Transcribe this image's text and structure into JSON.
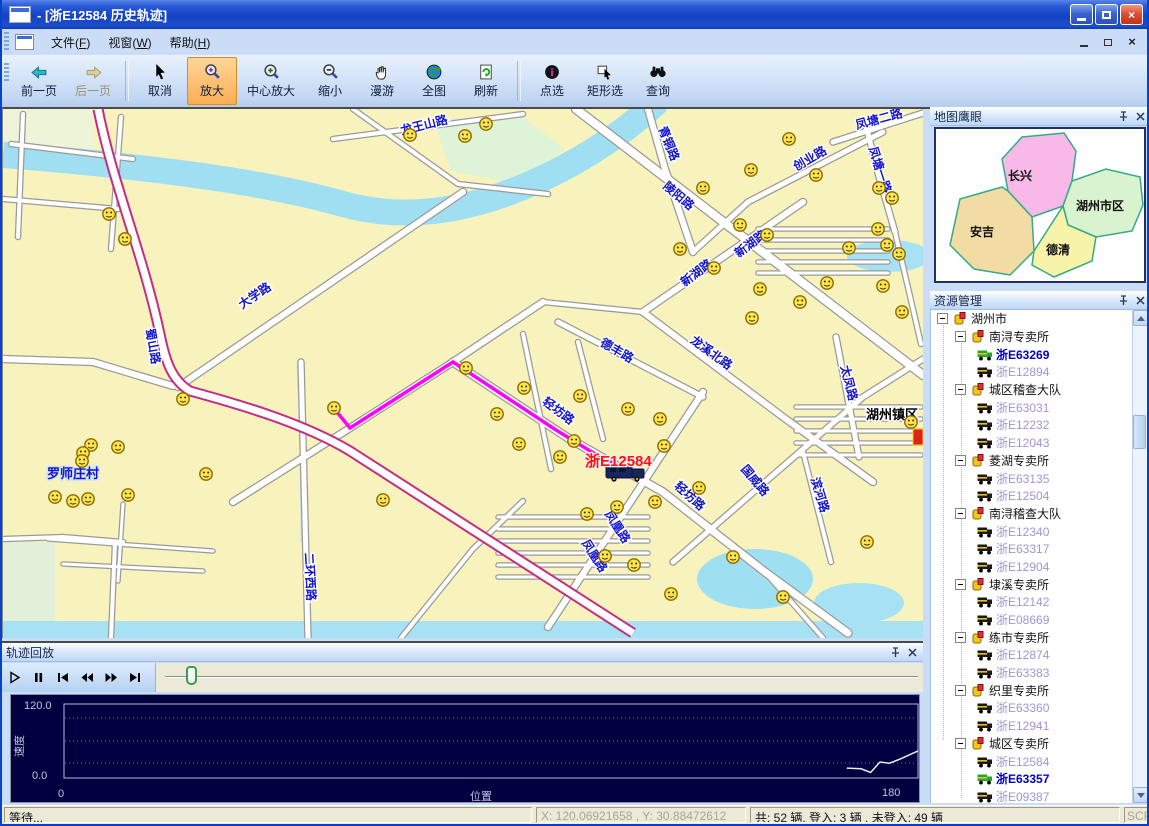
{
  "window": {
    "title": "- [浙E12584 历史轨迹]",
    "controls": [
      "minimize",
      "restore",
      "close"
    ]
  },
  "menu": {
    "items": [
      "文件(F)",
      "视窗(W)",
      "帮助(H)"
    ],
    "mdi_controls": [
      "minimize",
      "restore",
      "close"
    ]
  },
  "toolbar": {
    "buttons": [
      {
        "label": "前一页",
        "icon": "page-prev"
      },
      {
        "label": "后一页",
        "icon": "page-next",
        "disabled": true
      },
      {
        "sep": true
      },
      {
        "label": "取消",
        "icon": "cursor"
      },
      {
        "label": "放大",
        "icon": "zoom-in",
        "active": true
      },
      {
        "label": "中心放大",
        "icon": "zoom-center"
      },
      {
        "label": "缩小",
        "icon": "zoom-out"
      },
      {
        "label": "漫游",
        "icon": "pan-hand"
      },
      {
        "label": "全图",
        "icon": "globe"
      },
      {
        "label": "刷新",
        "icon": "refresh"
      },
      {
        "sep": true
      },
      {
        "label": "点选",
        "icon": "info-point"
      },
      {
        "label": "矩形选",
        "icon": "rect-select"
      },
      {
        "label": "查询",
        "icon": "binoculars"
      }
    ]
  },
  "map": {
    "road_labels": [
      {
        "t": "龙王山路",
        "x": 422,
        "y": 20,
        "r": -14
      },
      {
        "t": "青铜路",
        "x": 662,
        "y": 36,
        "r": 68
      },
      {
        "t": "陵阳路",
        "x": 673,
        "y": 90,
        "r": 40
      },
      {
        "t": "创业路",
        "x": 809,
        "y": 53,
        "r": -30
      },
      {
        "t": "凤塘二路",
        "x": 877,
        "y": 14,
        "r": -15
      },
      {
        "t": "凤塘一路",
        "x": 873,
        "y": 62,
        "r": 72
      },
      {
        "t": "新湖路",
        "x": 696,
        "y": 167,
        "r": -37
      },
      {
        "t": "大学路",
        "x": 254,
        "y": 190,
        "r": -34
      },
      {
        "t": "蜀山路",
        "x": 146,
        "y": 238,
        "r": 80
      },
      {
        "t": "德丰路",
        "x": 612,
        "y": 245,
        "r": 30
      },
      {
        "t": "龙溪北路",
        "x": 706,
        "y": 247,
        "r": 36
      },
      {
        "t": "轻坊路",
        "x": 553,
        "y": 305,
        "r": 37
      },
      {
        "t": "轻坊路",
        "x": 684,
        "y": 390,
        "r": 42
      },
      {
        "t": "凤凰路",
        "x": 588,
        "y": 449,
        "r": 57
      },
      {
        "t": "凤凰路",
        "x": 611,
        "y": 420,
        "r": 57
      },
      {
        "t": "国威路",
        "x": 749,
        "y": 374,
        "r": 50
      },
      {
        "t": "太凤路",
        "x": 842,
        "y": 275,
        "r": 76
      },
      {
        "t": "滨河路",
        "x": 813,
        "y": 387,
        "r": 73
      },
      {
        "t": "二环西路",
        "x": 303,
        "y": 468,
        "r": 87
      },
      {
        "t": "新湖路",
        "x": 750,
        "y": 138,
        "r": -37
      }
    ],
    "village_label": {
      "t": "罗师庄村",
      "x": 70,
      "y": 369
    },
    "town_label": {
      "t": "湖州镇区",
      "x": 889,
      "y": 310
    },
    "vehicle": {
      "label": "浙E12584",
      "label_x": 582,
      "label_y": 357,
      "x": 622,
      "y": 364
    },
    "track": [
      [
        333,
        302
      ],
      [
        347,
        319
      ],
      [
        450,
        253
      ],
      [
        553,
        321
      ],
      [
        592,
        345
      ],
      [
        618,
        358
      ]
    ],
    "smileys": [
      [
        106,
        105
      ],
      [
        122,
        130
      ],
      [
        407,
        26
      ],
      [
        462,
        27
      ],
      [
        483,
        15
      ],
      [
        748,
        61
      ],
      [
        786,
        30
      ],
      [
        813,
        66
      ],
      [
        876,
        79
      ],
      [
        889,
        89
      ],
      [
        875,
        120
      ],
      [
        884,
        136
      ],
      [
        896,
        145
      ],
      [
        880,
        177
      ],
      [
        846,
        139
      ],
      [
        824,
        174
      ],
      [
        899,
        203
      ],
      [
        737,
        116
      ],
      [
        764,
        126
      ],
      [
        700,
        79
      ],
      [
        677,
        140
      ],
      [
        711,
        159
      ],
      [
        757,
        180
      ],
      [
        797,
        193
      ],
      [
        749,
        209
      ],
      [
        521,
        279
      ],
      [
        577,
        287
      ],
      [
        625,
        300
      ],
      [
        657,
        310
      ],
      [
        494,
        305
      ],
      [
        516,
        335
      ],
      [
        571,
        332
      ],
      [
        661,
        337
      ],
      [
        463,
        259
      ],
      [
        331,
        299
      ],
      [
        180,
        290
      ],
      [
        584,
        405
      ],
      [
        652,
        393
      ],
      [
        696,
        379
      ],
      [
        602,
        447
      ],
      [
        631,
        456
      ],
      [
        668,
        485
      ],
      [
        730,
        448
      ],
      [
        780,
        488
      ],
      [
        88,
        336
      ],
      [
        80,
        344
      ],
      [
        115,
        338
      ],
      [
        79,
        352
      ],
      [
        52,
        388
      ],
      [
        70,
        392
      ],
      [
        85,
        390
      ],
      [
        125,
        386
      ],
      [
        203,
        365
      ],
      [
        380,
        391
      ],
      [
        557,
        348
      ],
      [
        614,
        398
      ],
      [
        864,
        433
      ],
      [
        908,
        313
      ]
    ]
  },
  "eagle_eye": {
    "title": "地图鹰眼",
    "regions": [
      {
        "name": "长兴",
        "color": "#F9B9E8"
      },
      {
        "name": "湖州市区",
        "color": "#D9F3CF"
      },
      {
        "name": "安吉",
        "color": "#F2DCA4"
      },
      {
        "name": "德清",
        "color": "#F7F3A8"
      }
    ]
  },
  "resources": {
    "title": "资源管理",
    "root": "湖州市",
    "groups": [
      {
        "name": "南浔专卖所",
        "vehicles": [
          {
            "id": "浙E63269",
            "online": true
          },
          {
            "id": "浙E12894"
          }
        ]
      },
      {
        "name": "城区稽查大队",
        "vehicles": [
          {
            "id": "浙E63031"
          },
          {
            "id": "浙E12232"
          },
          {
            "id": "浙E12043"
          }
        ]
      },
      {
        "name": "菱湖专卖所",
        "vehicles": [
          {
            "id": "浙E63135"
          },
          {
            "id": "浙E12504"
          }
        ]
      },
      {
        "name": "南浔稽查大队",
        "vehicles": [
          {
            "id": "浙E12340"
          },
          {
            "id": "浙E63317"
          },
          {
            "id": "浙E12904"
          }
        ]
      },
      {
        "name": "埭溪专卖所",
        "vehicles": [
          {
            "id": "浙E12142"
          },
          {
            "id": "浙E08669"
          }
        ]
      },
      {
        "name": "练市专卖所",
        "vehicles": [
          {
            "id": "浙E12874"
          },
          {
            "id": "浙E63383"
          }
        ]
      },
      {
        "name": "织里专卖所",
        "vehicles": [
          {
            "id": "浙E63360"
          },
          {
            "id": "浙E12941"
          }
        ]
      },
      {
        "name": "城区专卖所",
        "vehicles": [
          {
            "id": "浙E12584"
          },
          {
            "id": "浙E63357",
            "online": true
          },
          {
            "id": "浙E09387"
          }
        ]
      }
    ]
  },
  "playback": {
    "title": "轨迹回放",
    "controls": [
      "play",
      "pause",
      "step-start",
      "rewind",
      "fast-forward",
      "step-end"
    ],
    "slider_percent": 2.8,
    "chart": {
      "type": "line",
      "ylabel": "速度",
      "xlabel": "位置",
      "ymax_label": "120.0",
      "ymin_label": "0.0",
      "xmin_label": "0",
      "xmax_label": "180",
      "ylim": [
        0,
        120
      ],
      "xlim": [
        0,
        180
      ],
      "series": [
        {
          "name": "speed",
          "points": [
            [
              165,
              16
            ],
            [
              168,
              15
            ],
            [
              170,
              9
            ],
            [
              172,
              26
            ],
            [
              174,
              24
            ],
            [
              176,
              30
            ],
            [
              180,
              44
            ]
          ]
        }
      ]
    }
  },
  "status": {
    "message": "等待...",
    "coords": "X: 120.06921658 , Y: 30.88472612",
    "counts": "共: 52 辆. 登入: 3 辆 , 未登入: 49 辆",
    "scroll": "SCRL"
  }
}
